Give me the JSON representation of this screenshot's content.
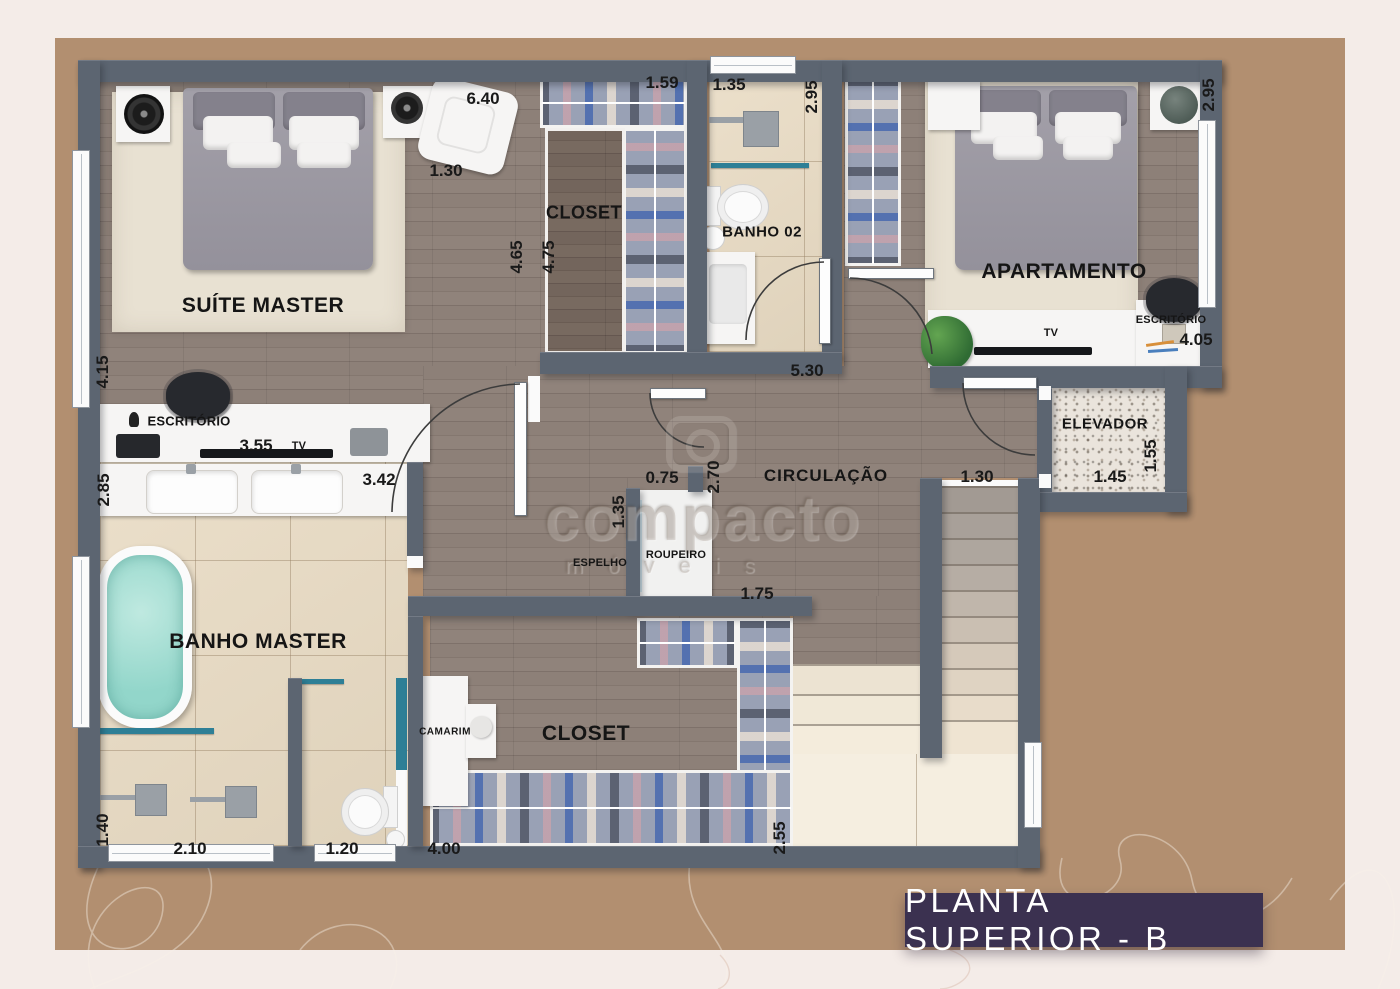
{
  "banner": {
    "title": "PLANTA SUPERIOR - B"
  },
  "watermark": {
    "brand": "compacto",
    "sub": "móveis"
  },
  "rooms": {
    "suite_master": "SUÍTE MASTER",
    "closet_top": "CLOSET",
    "banho02": "BANHO 02",
    "apartamento": "APARTAMENTO",
    "escritorio_suite": "ESCRITÓRIO",
    "escritorio_apto": "ESCRITÓRIO",
    "tv_suite": "TV",
    "tv_apto": "TV",
    "elevador": "ELEVADOR",
    "circulacao": "CIRCULAÇÃO",
    "espelho": "ESPELHO",
    "roupeiro": "ROUPEIRO",
    "banho_master": "BANHO MASTER",
    "camarim": "CAMARIM",
    "closet_bottom": "CLOSET"
  },
  "dims": {
    "suite_width": "6.40",
    "suite_chair": "1.30",
    "closet_top_w": "1.59",
    "banho02_w": "1.35",
    "banho02_d": "2.95",
    "apto_d": "2.95",
    "closet_d1": "4.65",
    "closet_d2": "4.75",
    "suite_side": "4.15",
    "tv_wall": "3.55",
    "vanity_w": "3.42",
    "vanity_side": "2.85",
    "circ_w": "5.30",
    "apto_w": "4.05",
    "elev_d": "1.55",
    "elev_w": "1.45",
    "elev_hall": "1.30",
    "roup_top": "0.75",
    "roup_side": "2.70",
    "roup_left": "1.35",
    "roup_bottom": "1.75",
    "shower_side": "1.40",
    "shower_w": "2.10",
    "wc_w": "1.20",
    "closetb_w": "4.00",
    "closetb_d": "2.55"
  },
  "colors": {
    "wall": "#5c6571",
    "mat": "#b28f70",
    "page": "#f4ece8",
    "banner": "#3b3150",
    "accent": "#2e7f96"
  }
}
